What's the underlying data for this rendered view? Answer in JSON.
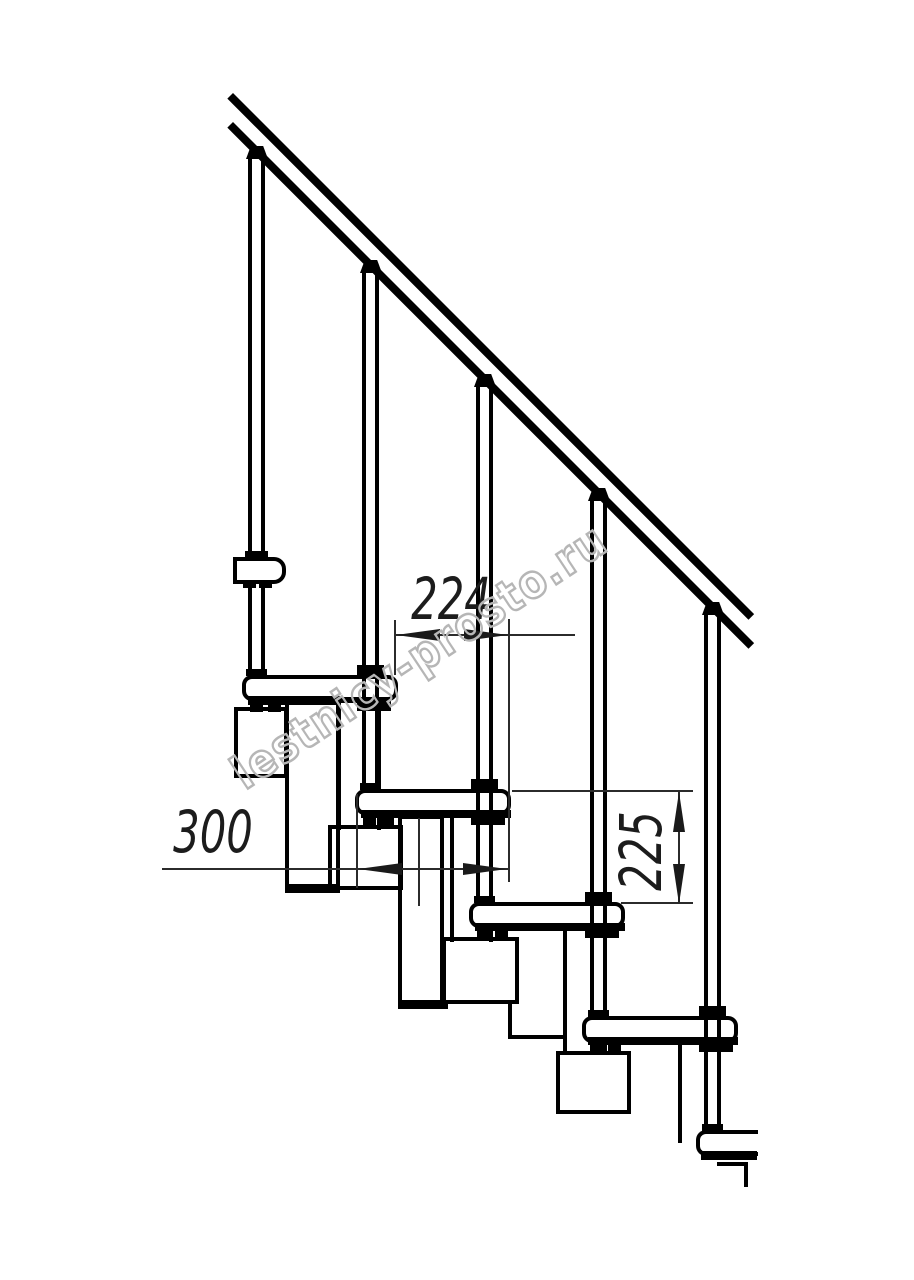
{
  "drawing": {
    "title": "Modular staircase side-view technical drawing",
    "dimensions": {
      "going_label": "224",
      "tread_depth_label": "300",
      "riser_height_label": "225"
    },
    "watermark": {
      "text": "lestnicy-prosto.ru"
    },
    "colors": {
      "line": "#000000",
      "dimension_line": "#2b2b2b",
      "watermark_outline": "#b6b6b6",
      "background": "#ffffff"
    }
  }
}
